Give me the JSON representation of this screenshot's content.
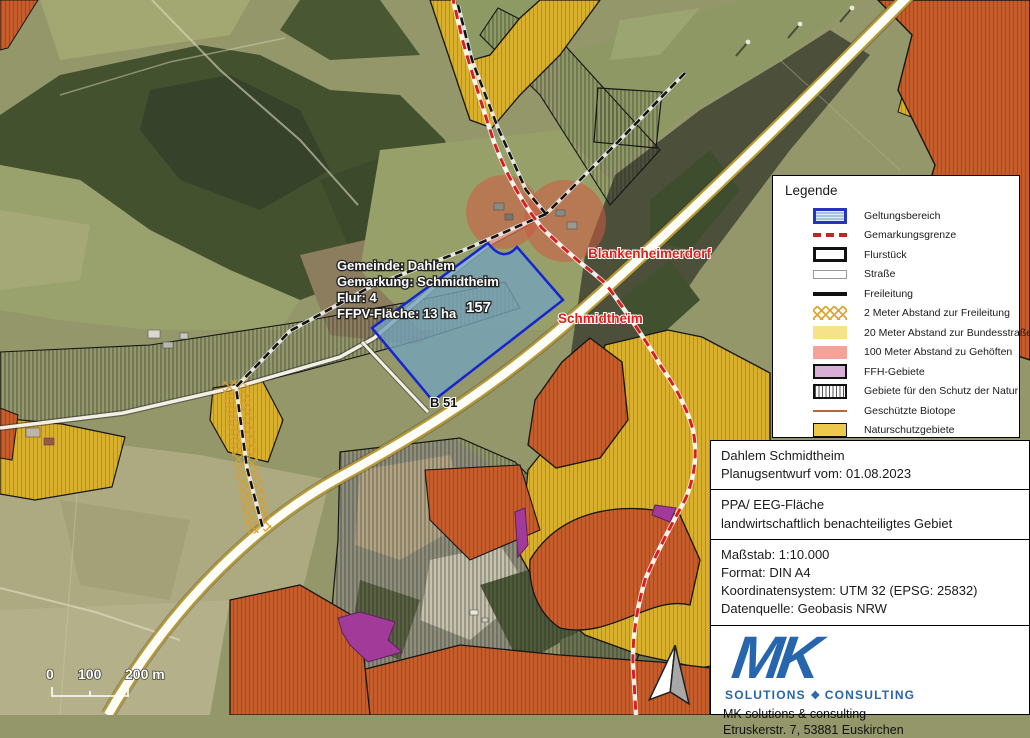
{
  "map": {
    "labels": {
      "gemeinde": "Gemeinde: Dahlem",
      "gemarkung": "Gemarkung: Schmidtheim",
      "flur": "Flur: 4",
      "flaeche": "FFPV-Fläche: 13 ha",
      "parcel_number": "157",
      "place_north": "Blankenheimerdorf",
      "place_south": "Schmidtheim",
      "road": "B 51"
    },
    "scale_bar": {
      "tick0": "0",
      "tick100": "100",
      "tick200": "200 m"
    },
    "colors": {
      "geltungsbereich_fill": "#74a2ba",
      "geltungsbereich_border": "#1526cf",
      "gemarkungsgrenze_red": "#d42020",
      "buffer_gehoefte_red": "#d05a42",
      "naturschutz_gold": "#d9af2e",
      "schutzgebiet_orange": "#c65d2c",
      "ffh_purple": "#a23a9a",
      "road_yellow_edge": "#b89a35"
    }
  },
  "legend": {
    "title": "Legende",
    "items": [
      {
        "label": "Geltungsbereich",
        "swatch": "geltungsbereich"
      },
      {
        "label": "Gemarkungsgrenze",
        "swatch": "gemarkungsgrenze"
      },
      {
        "label": "Flurstück",
        "swatch": "flurstueck"
      },
      {
        "label": "Straße",
        "swatch": "strasse"
      },
      {
        "label": "Freileitung",
        "swatch": "freileitung"
      },
      {
        "label": "2 Meter Abstand zur Freileitung",
        "swatch": "abstand-freileitung"
      },
      {
        "label": "20 Meter Abstand zur Bundesstraße",
        "swatch": "abstand-bundesstrasse"
      },
      {
        "label": "100 Meter Abstand zu Gehöften",
        "swatch": "abstand-gehoefte"
      },
      {
        "label": "FFH-Gebiete",
        "swatch": "ffh"
      },
      {
        "label": "Gebiete für den Schutz der Natur",
        "swatch": "schutz-natur"
      },
      {
        "label": "Geschützte Biotope",
        "swatch": "biotope"
      },
      {
        "label": "Naturschutzgebiete",
        "swatch": "naturschutz"
      }
    ]
  },
  "info_box": {
    "title_line1": "Dahlem Schmidtheim",
    "title_line2": "Planugsentwurf vom: 01.08.2023",
    "area_line1": "PPA/ EEG-Fläche",
    "area_line2": "landwirtschaftlich benachteiligtes Gebiet",
    "meta_line1": "Maßstab: 1:10.000",
    "meta_line2": "Format: DIN A4",
    "meta_line3": "Koordinatensystem: UTM 32 (EPSG: 25832)",
    "meta_line4": "Datenquelle: Geobasis NRW"
  },
  "logo": {
    "mark": "MK",
    "sub_left": "SOLUTIONS",
    "diamond": "❖",
    "sub_right": "CONSULTING",
    "address_line1": "MK solutions & consulting",
    "address_line2": "Etruskerstr. 7, 53881 Euskirchen",
    "brand_blue": "#2765ad"
  }
}
